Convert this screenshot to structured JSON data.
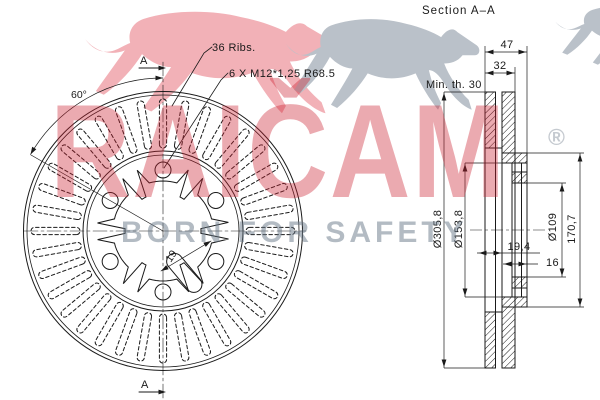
{
  "section_title": "Section  A–A",
  "front": {
    "cut_label_top": "A",
    "cut_label_bottom": "A",
    "angle": "60°",
    "ribs": "36 Ribs.",
    "bolts": "6 X M12*1,25 R68.5",
    "slot_width": "19"
  },
  "section": {
    "width_total": "47",
    "width_pads": "32",
    "min_thickness": "Min. th. 30",
    "offset": "19,4",
    "pad_thickness": "16",
    "outer_diameter": "Ø305,8",
    "hat_diameter": "Ø153,8",
    "bolt_circle_diameter": "Ø109",
    "hat_height": "170,7"
  },
  "watermark": {
    "brand": "RAIČAM",
    "registered": "®",
    "slogan": "BORN FOR SAFETY",
    "brand_color": "rgba(203,32,48,0.38)",
    "registered_color": "#c5cad0",
    "slogan_color": "rgba(104,119,136,0.5)",
    "cheetah_pink": "#f2b1b7",
    "cheetah_gray": "#bac1c9",
    "line_color": "#1a1a1a"
  }
}
